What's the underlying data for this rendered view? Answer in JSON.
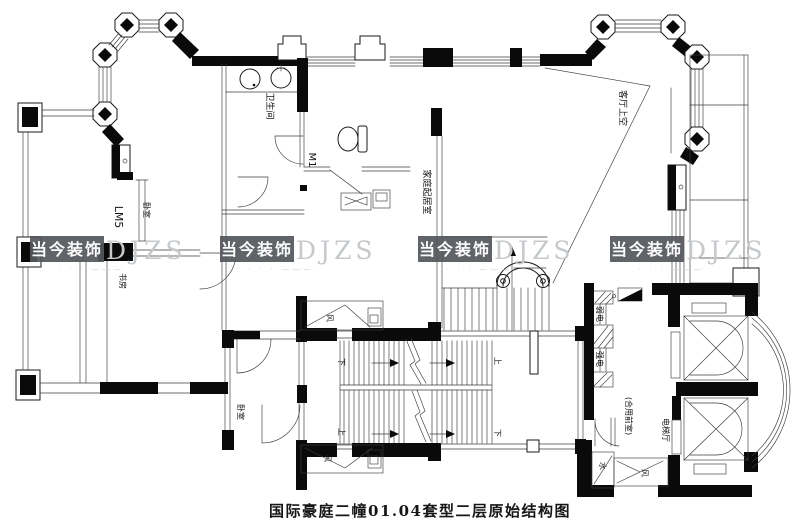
{
  "caption": "国际豪庭二幢01.04套型二层原始结构图",
  "watermark": {
    "cn": "当今装饰",
    "en": "DJZS",
    "tagline": "· · · ———"
  },
  "rooms": {
    "bathroom": "卫生间",
    "family_living_room": "家庭起居室",
    "living_room_void": "客厅上空",
    "bedroom_upper": "卧室",
    "study": "书房",
    "bedroom_lower": "卧室",
    "shared_front_room": "(合用前室)",
    "elevator_hall": "电梯厅"
  },
  "codes": {
    "door": "M1",
    "window": "LM5"
  },
  "shafts": {
    "weak_electric": "弱电",
    "strong_electric": "强电",
    "air": "风",
    "water": "水"
  },
  "stairs": {
    "up": "上",
    "down": "下"
  }
}
